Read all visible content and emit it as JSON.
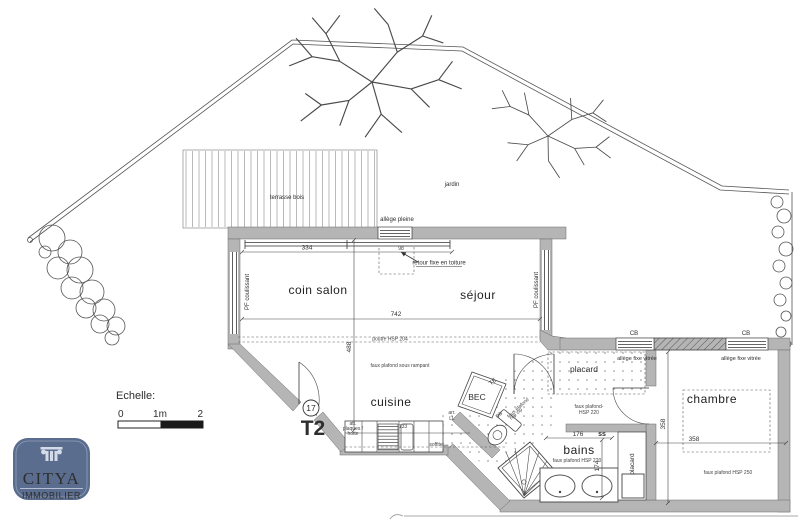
{
  "plan": {
    "unit": {
      "badge": "17",
      "type": "T2"
    },
    "labels": {
      "terrasse": "terrasse bois",
      "jardin": "jardin",
      "coin_salon": "coin salon",
      "sejour": "séjour",
      "cuisine": "cuisine",
      "bains": "bains",
      "chambre": "chambre",
      "placard_hall": "placard",
      "placard_bains": "placard",
      "bec": "BEC",
      "allege_pleine": "allège pleine",
      "retour_fixe": "retour fixe en toiture",
      "pf_coulissant": "PF coulissant",
      "poutre": "poutre HSP 204",
      "faux_plafond_rampant": "faux plafond sous rampant",
      "faux_plafond_hall_l1": "faux plafond-",
      "faux_plafond_hall_l2": "HSP 220",
      "faux_plafond_bains": "faux plafond HSP 220",
      "faux_plafond_chambre": "faux plafond HSP 250",
      "allege_fixe": "allège fixe vitrée",
      "cb": "CB",
      "te": "TE",
      "db": "DB",
      "arr_l1": "arr.",
      "arr_l2": "LL",
      "att_l1": "att.",
      "att_l2": "plaques /",
      "att_l3": "hotte",
      "soffite": "soffite",
      "ss": "ss",
      "wc_l1": "faux plafond",
      "wc_l2": "rep cip"
    },
    "dims": {
      "d334": "334",
      "d742": "742",
      "d488": "488",
      "d98": "98",
      "d133": "133",
      "d176": "176",
      "d174": "174",
      "d358a": "358",
      "d358b": "358"
    },
    "scale": {
      "title": "Echelle:",
      "t0": "0",
      "t1": "1m",
      "t2": "2"
    }
  },
  "logo": {
    "name": "CITYA",
    "tagline": "IMMOBILIER"
  },
  "colors": {
    "wall": "#b5b5b5",
    "accent_blue": "#2b2e9e",
    "logo_bg": "#5b6d8e",
    "logo_text": "#d3dae8"
  }
}
